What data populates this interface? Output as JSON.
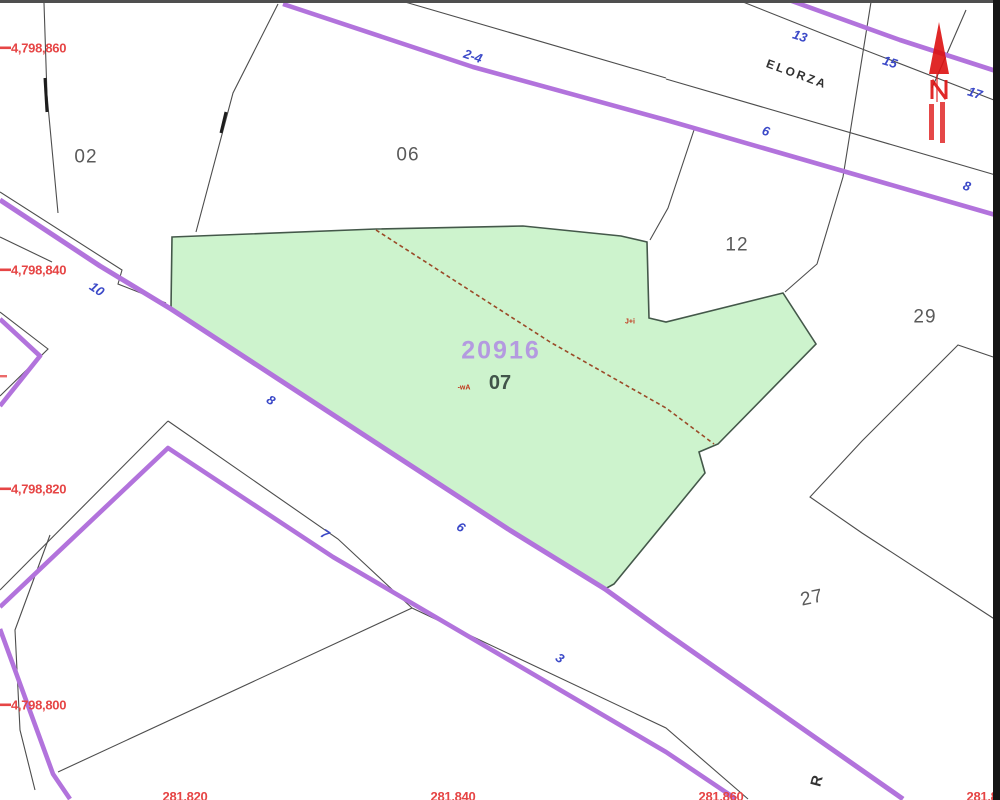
{
  "map": {
    "kind": "cadastral-parcel-map",
    "selected_parcel": {
      "number": "20916",
      "sub": "07"
    },
    "street_name": "ELORZA",
    "colors": {
      "road_purple": "#b273dc",
      "selected_parcel_fill": "#cdf3cd",
      "selected_parcel_number_text": "#b49ae0",
      "coordinate_label_red": "#e64545",
      "street_number_blue": "#3b49c8",
      "parcel_number_gray": "#5a5a5a",
      "boundary_line": "#4d4d4d",
      "old_boundary_dashed": "#9a4a28",
      "north_arrow_red": "#dd1111"
    }
  },
  "labels": {
    "coord_left": [
      {
        "text": "4,798,860"
      },
      {
        "text": "4,798,840"
      },
      {
        "text": "4,798,820"
      },
      {
        "text": "4,798,800"
      }
    ],
    "coord_bottom": [
      {
        "text": "281,820"
      },
      {
        "text": "281,840"
      },
      {
        "text": "281,860"
      },
      {
        "text": "281,880"
      }
    ],
    "street_numbers": [
      {
        "text": "2-4"
      },
      {
        "text": "13"
      },
      {
        "text": "15"
      },
      {
        "text": "17"
      },
      {
        "text": "6"
      },
      {
        "text": "8"
      },
      {
        "text": "10"
      },
      {
        "text": "8"
      },
      {
        "text": "7"
      },
      {
        "text": "6"
      },
      {
        "text": "3"
      }
    ],
    "parcel_numbers": [
      {
        "text": "02"
      },
      {
        "text": "06"
      },
      {
        "text": "12"
      },
      {
        "text": "29"
      },
      {
        "text": "27"
      }
    ],
    "selected": {
      "number": "20916",
      "sub": "07"
    },
    "street_name": {
      "text": "ELORZA"
    },
    "rotated_r": {
      "text": "R"
    },
    "tiny_annotations": [
      {
        "text": "J+i"
      },
      {
        "text": "-wA"
      }
    ]
  }
}
